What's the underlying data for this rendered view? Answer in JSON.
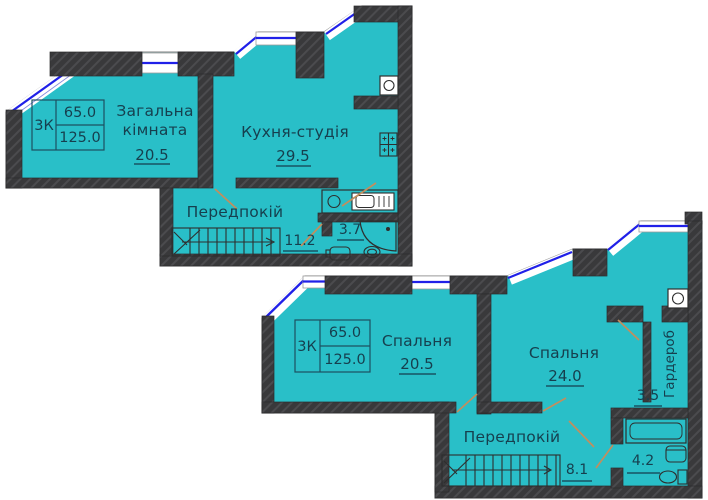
{
  "upper": {
    "info": {
      "rooms": "3К",
      "living_area": "65.0",
      "total_area": "125.0"
    },
    "living": {
      "line1": "Загальна",
      "line2": "кімната",
      "area": "20.5"
    },
    "kitchen": {
      "name": "Кухня-студія",
      "area": "29.5"
    },
    "hall": {
      "name": "Передпокій",
      "area": "11.2"
    },
    "bath": {
      "area": "3.7"
    }
  },
  "lower": {
    "info": {
      "rooms": "3К",
      "living_area": "65.0",
      "total_area": "125.0"
    },
    "bedroom1": {
      "name": "Спальня",
      "area": "20.5"
    },
    "bedroom2": {
      "name": "Спальня",
      "area": "24.0"
    },
    "hall": {
      "name": "Передпокій",
      "area": "8.1"
    },
    "bath": {
      "area": "4.2"
    },
    "wardrobe": {
      "name": "Гардероб",
      "area": "3.5"
    }
  },
  "colors": {
    "floor": "#29bfc8",
    "wall": "#39393b",
    "window_line": "#2020e8",
    "door_swing": "#c28e5e",
    "label_text": "#163f4e"
  }
}
